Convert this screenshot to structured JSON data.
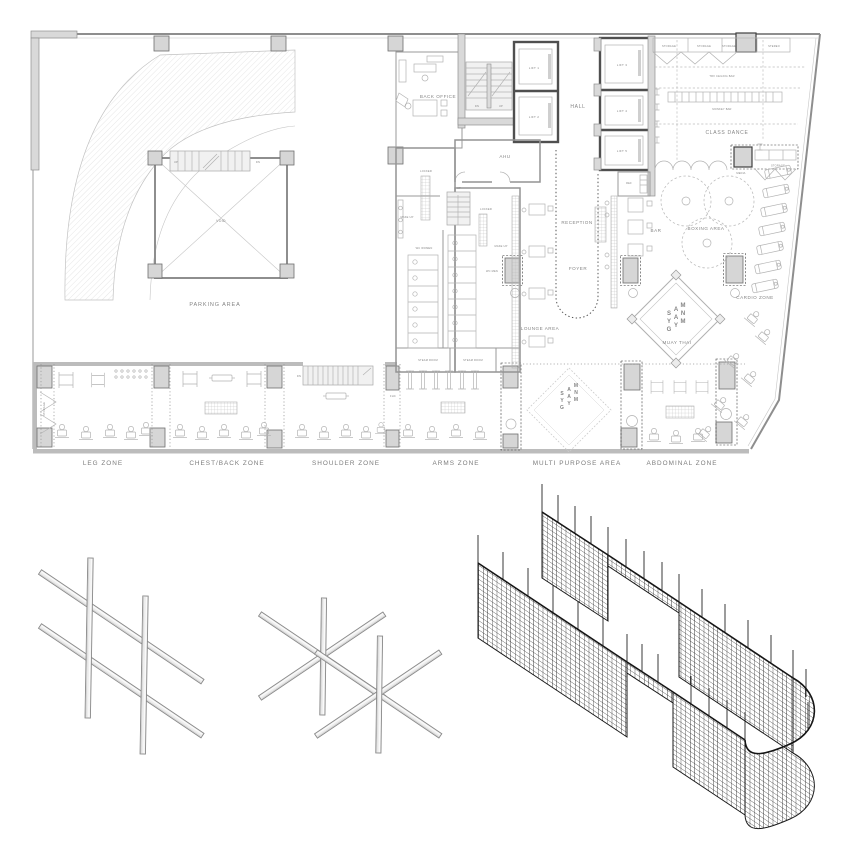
{
  "colors": {
    "wall": "#8f8f8f",
    "dark_wall": "#4a4a4a",
    "column_fill": "#d6d6d6",
    "label_text": "#858585",
    "mesh_line": "#1a1a1a",
    "beam_fill": "#ededed",
    "background": "#ffffff"
  },
  "plan": {
    "rooms": {
      "parking": "PARKING AREA",
      "void": "VOID",
      "back_office": "BACK OFFICE",
      "hall": "HALL",
      "ahu": "AHU",
      "reception": "RECEPTION",
      "ref": "REF",
      "bar": "BAR",
      "foyer": "FOYER",
      "lounge": "LOUNGE AREA",
      "class_dance": "CLASS DANCE",
      "boxing": "BOXING AREA",
      "cardio": "CARDIO  ZONE",
      "muay_thai": "MUAY THAI",
      "storage": "STORAGE",
      "stereo": "STEREO",
      "media": "MEDIA",
      "trx_bar": "TRX CEILING BAR",
      "monkey_bar": "MONKEY BAR",
      "locker": "LOCKER",
      "make_up": "MAKE UP",
      "wc_women": "WC WOMEN",
      "wc_men": "WC MEN",
      "steam_room": "STEAM ROOM",
      "fhc": "FHC"
    },
    "circulation": {
      "up": "UP",
      "dn": "DN"
    },
    "lifts": [
      "LIFT 1",
      "LIFT 2",
      "LIFT 3",
      "LIFT 4",
      "LIFT 5"
    ],
    "zones": [
      "LEG ZONE",
      "CHEST/BACK ZONE",
      "SHOULDER ZONE",
      "ARMS ZONE",
      "MULTI PURPOSE AREA",
      "ABDOMINAL ZONE"
    ],
    "monogram": {
      "letters": [
        "S",
        "A",
        "M",
        "Y",
        "A",
        "N",
        "G",
        "Y",
        "M"
      ]
    }
  }
}
